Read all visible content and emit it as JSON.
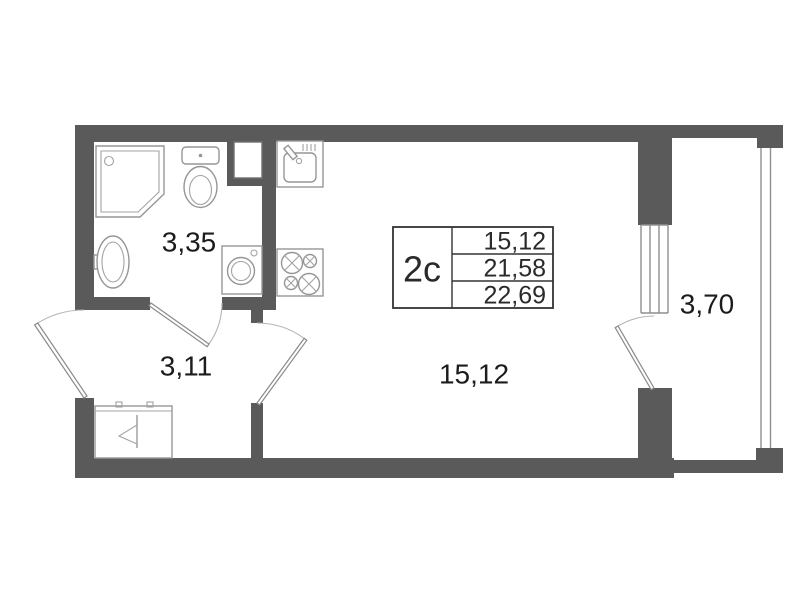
{
  "floor_plan": {
    "unit_box": {
      "type_label": "2c",
      "rows": [
        "15,12",
        "21,58",
        "22,69"
      ]
    },
    "rooms": {
      "bathroom": {
        "area": "3,35"
      },
      "hallway": {
        "area": "3,11"
      },
      "living_room": {
        "area": "15,12"
      },
      "balcony": {
        "area": "3,70"
      }
    },
    "symbols": [
      "shower-icon",
      "toilet-icon",
      "washbasin-icon",
      "washing-machine-icon",
      "kitchen-sink-icon",
      "stove-icon",
      "wardrobe-icon",
      "duct-shaft-icon",
      "door-swing-icon",
      "window-icon",
      "balcony-railing-icon"
    ],
    "colors": {
      "wall": "#5a5a5a",
      "fixture_stroke": "#969696",
      "door_stroke": "#8a8a8a",
      "text": "#1c1c1c",
      "box_border": "#333333",
      "background": "#ffffff"
    }
  }
}
